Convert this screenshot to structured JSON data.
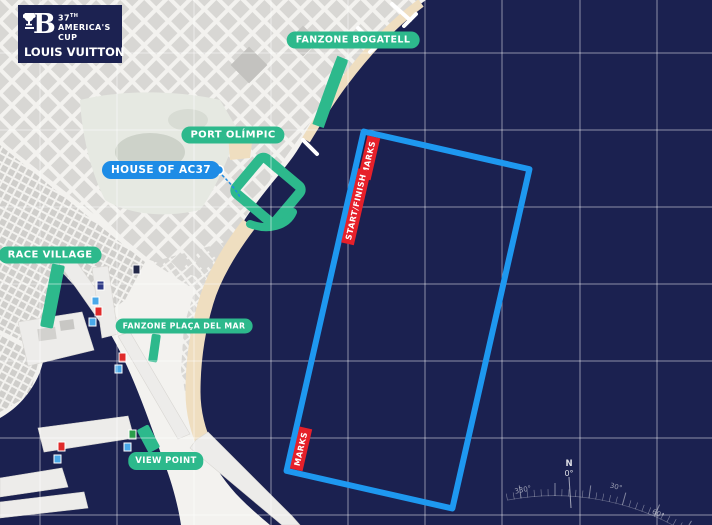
{
  "colors": {
    "sea": "#1b2150",
    "land": "#f3f2ef",
    "green": "#2db98c",
    "course_blue": "#1e98f0",
    "label_blue": "#1e8ce6",
    "red": "#e6202a",
    "sand": "#efdec0",
    "logo_navy": "#1c2251"
  },
  "logo": {
    "monogram": "B",
    "cup_number": "37",
    "cup_ordinal": "TH",
    "cup_line2": "AMERICA'S",
    "cup_line3": "CUP",
    "brand": "LOUIS VUITTON"
  },
  "map_labels": {
    "fanzone_bogatell": "FANZONE BOGATELL",
    "port_olimpic": "PORT OLÍMPIC",
    "house_of_ac37": "HOUSE OF AC37",
    "race_village": "RACE VILLAGE",
    "fanzone_placa_del_mar": "FANZONE PLAÇA DEL MAR",
    "view_point": "VIEW POINT"
  },
  "course_labels": {
    "marks_top": "MARKS",
    "start_finish": "START/FINISH",
    "marks_bottom": "MARKS"
  },
  "compass": {
    "north_letter": "N",
    "north_deg": "0°",
    "deg_330": "330°",
    "deg_30": "30°",
    "deg_60": "60°"
  }
}
